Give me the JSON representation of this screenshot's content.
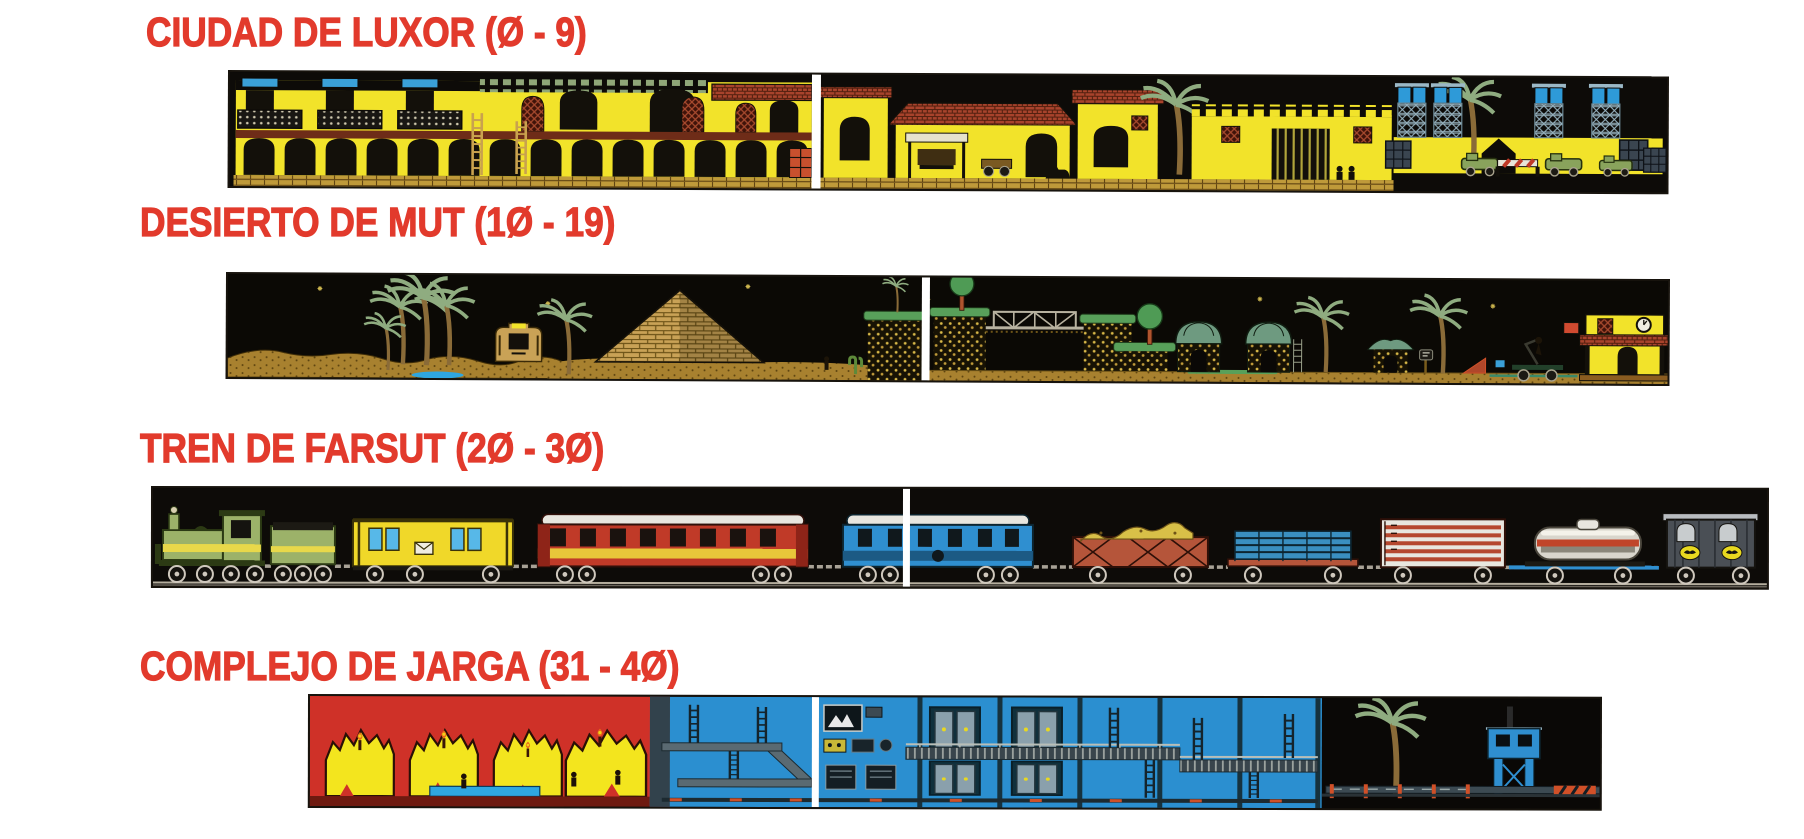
{
  "page": {
    "background_color": "#ffffff",
    "heading_color": "#e23a2c",
    "description": "Magazine map-guide page with four pixel-art game level strips",
    "palette": {
      "strip_background": "#0d0b08",
      "city_yellow": "#f2e32a",
      "roof_red": "#a8432c",
      "desert_sand": "#a8812f",
      "train_green": "#9cb269",
      "complex_blue": "#2b8fd0",
      "cave_red": "#cf3128",
      "scaffold_blue": "#2e9ad8"
    }
  },
  "sections": [
    {
      "id": "ciudad-de-luxor",
      "title": "CIUDAD DE LUXOR (Ø - 9)",
      "levels_from": 0,
      "levels_to": 9,
      "map_alt": "Side-scrolling map of the Luxor city levels: yellow adobe buildings with arcades, balconies and ladders, red tiled roofs, a shop awning, palm trees, a crenellated fortress with barred gate, and blue scaffold towers, green carts, a striped barrier and barrel stacks on a yellow esplanade under a black sky"
    },
    {
      "id": "desierto-de-mut",
      "title": "DESIERTO DE MUT (1Ø - 19)",
      "levels_from": 10,
      "levels_to": 19,
      "map_alt": "Side-scrolling map of the Mut desert levels: starry black sky over sand dunes, palm trees, a sphinx head, a brick pyramid, grass-topped mesas joined by a truss bridge, round trees, domed huts, a rail handcar with pump lever and a yellow station house with clock, tiled awning and hanging red sign"
    },
    {
      "id": "tren-de-farsut",
      "title": "TREN DE FARSUT (2Ø - 3Ø)",
      "levels_from": 20,
      "levels_to": 30,
      "map_alt": "Side-view map of the Farsut train levels: a green steam locomotive and tender pulling a yellow mail coach, a red coach with white roof and yellow stripe, a blue coach, an ore wagon with yellow load, a flat wagon stacked with blue pipes, a white boxcar with red stripes, a silver tank wagon with red band and a dark armoured van with yellow emblems, all on a rail line over black"
    },
    {
      "id": "complejo-de-jarga",
      "title": "COMPLEJO DE JARGA (31 - 4Ø)",
      "levels_from": 31,
      "levels_to": 40,
      "map_alt": "Side-scrolling map of the Jarga complex levels: red caves with jagged yellow chambers, torches, stalagmites and a blue water pool, leading into a blue industrial base with control screens, double doors, grated walkways, ladders and pillars, ending at a black fenced yard with a palm tree, hazard stripes and a blue watchtower"
    }
  ]
}
